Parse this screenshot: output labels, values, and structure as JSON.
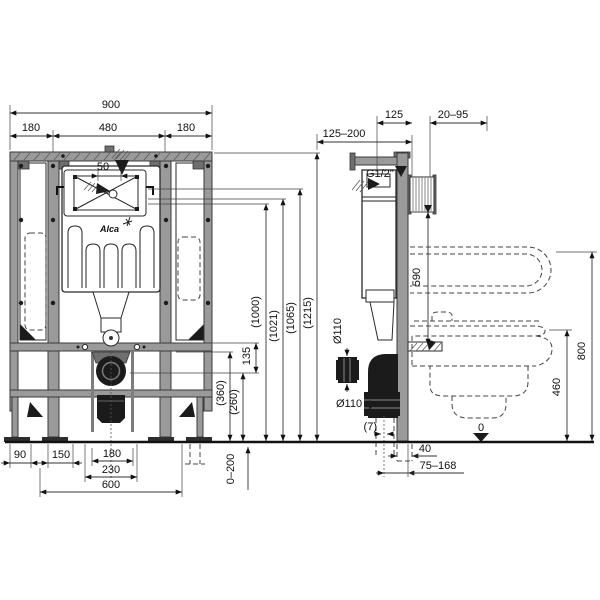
{
  "front_view": {
    "logo": "Alca",
    "dims": {
      "total_width": "900",
      "seg_left": "180",
      "seg_center": "480",
      "seg_right": "180",
      "flush_offset": "50",
      "h_1000": "(1000)",
      "h_1021": "(1021)",
      "h_1065": "(1065)",
      "h_1215": "(1215)",
      "h_135": "135",
      "h_360": "(360)",
      "h_260": "(260)",
      "b_90": "90",
      "b_150": "150",
      "b_180": "180",
      "b_230": "230",
      "b_600": "600",
      "leg_adjust": "0–200"
    }
  },
  "side_view": {
    "dims": {
      "wall_offset": "125–200",
      "frame_depth": "125",
      "finish_range": "20–95",
      "water_inlet": "G1/2\"",
      "inlet_height": "590",
      "pipe_dia_outlet": "Ø110",
      "pipe_dia_elbow": "Ø110",
      "offset_7": "(7)",
      "floor_zero": "0",
      "pipe_40": "40",
      "range_75_168": "75–168",
      "h_800": "800",
      "h_460": "460"
    }
  }
}
